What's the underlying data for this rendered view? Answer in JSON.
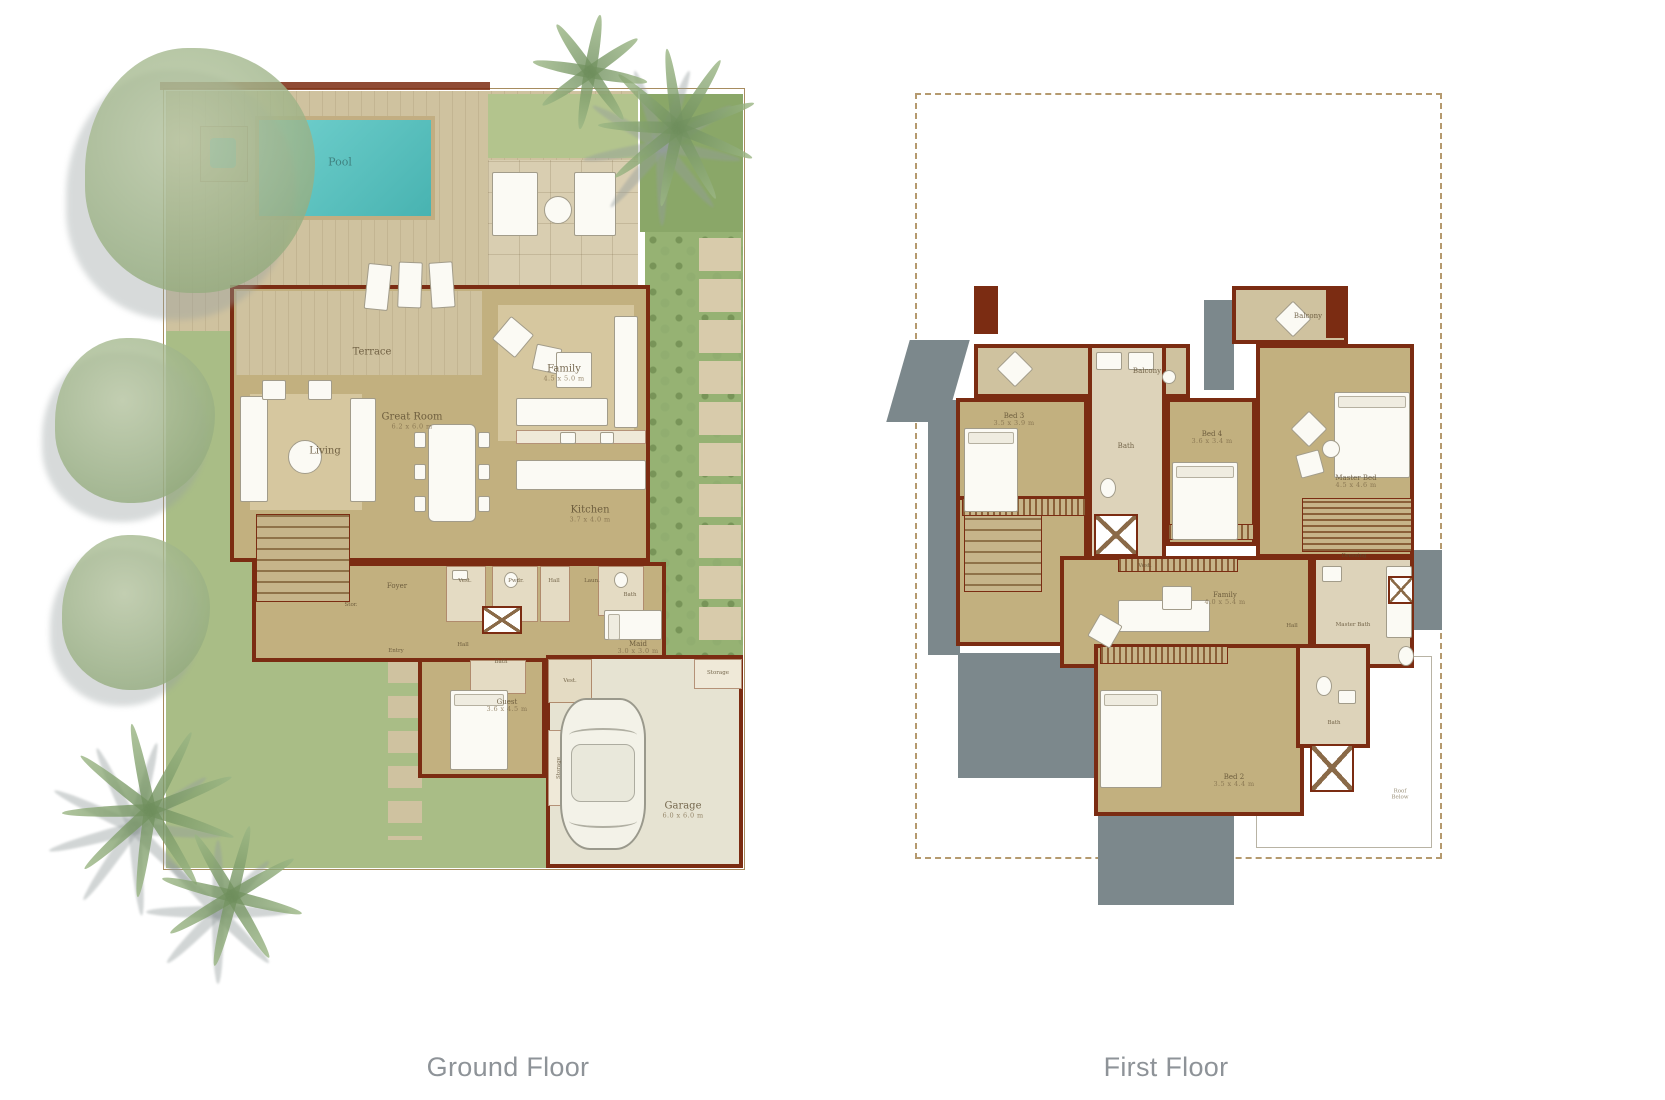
{
  "captions": {
    "ground_floor": "Ground Floor",
    "first_floor": "First Floor"
  },
  "palette": {
    "wall": "#7b2c12",
    "floor": "#c2b07f",
    "deck": "#cfc29f",
    "pool_water": "#5ec5c3",
    "lawn": "#a9bd86",
    "planting": "#96b273",
    "shadow": "#7c888c",
    "paver": "#d8cbab",
    "label": "#6f5c3e",
    "caption": "#8e9398",
    "boundary": "#a78c5f"
  },
  "ground_floor": {
    "title": "Ground Floor",
    "rooms": {
      "pool": {
        "label": "Pool"
      },
      "terrace": {
        "label": "Terrace"
      },
      "living": {
        "label": "Living"
      },
      "great_room": {
        "label": "Great Room",
        "dims": "6.2 x 6.0 m"
      },
      "family": {
        "label": "Family",
        "dims": "4.5 x 5.0 m"
      },
      "kitchen": {
        "label": "Kitchen",
        "dims": "3.7 x 4.0 m"
      },
      "foyer": {
        "label": "Foyer"
      },
      "stor": {
        "label": "Stor."
      },
      "entry": {
        "label": "Entry"
      },
      "vest1": {
        "label": "Vest."
      },
      "powder": {
        "label": "Pwdr."
      },
      "hall1": {
        "label": "Hall"
      },
      "laundry": {
        "label": "Laun."
      },
      "bath1": {
        "label": "Bath"
      },
      "maid": {
        "label": "Maid",
        "dims": "3.0 x 3.0 m"
      },
      "hall2": {
        "label": "Hall"
      },
      "bath2": {
        "label": "Bath"
      },
      "vest2": {
        "label": "Vest."
      },
      "guest": {
        "label": "Guest",
        "dims": "3.6 x 4.5 m"
      },
      "garage": {
        "label": "Garage",
        "dims": "6.0 x 6.0 m"
      },
      "storage_side": {
        "label": "Storage"
      },
      "storage_nook": {
        "label": "Storage"
      }
    }
  },
  "first_floor": {
    "title": "First Floor",
    "rooms": {
      "balcony_left": {
        "label": "Balcony"
      },
      "balcony_right": {
        "label": "Balcony"
      },
      "bed3": {
        "label": "Bed 3",
        "dims": "3.5 x 3.9 m"
      },
      "bath_shared": {
        "label": "Bath"
      },
      "bed4": {
        "label": "Bed 4",
        "dims": "3.6 x 3.4 m"
      },
      "master_bed": {
        "label": "Master Bed",
        "dims": "4.5 x 4.6 m"
      },
      "dressing": {
        "label": "Dressing"
      },
      "vest": {
        "label": "Vest."
      },
      "family": {
        "label": "Family",
        "dims": "4.0 x 5.4 m"
      },
      "hall": {
        "label": "Hall"
      },
      "master_bath": {
        "label": "Master Bath"
      },
      "bath2": {
        "label": "Bath"
      },
      "bed2": {
        "label": "Bed 2",
        "dims": "3.5 x 4.4 m"
      },
      "roof_below": {
        "label": "Roof Below"
      }
    }
  }
}
